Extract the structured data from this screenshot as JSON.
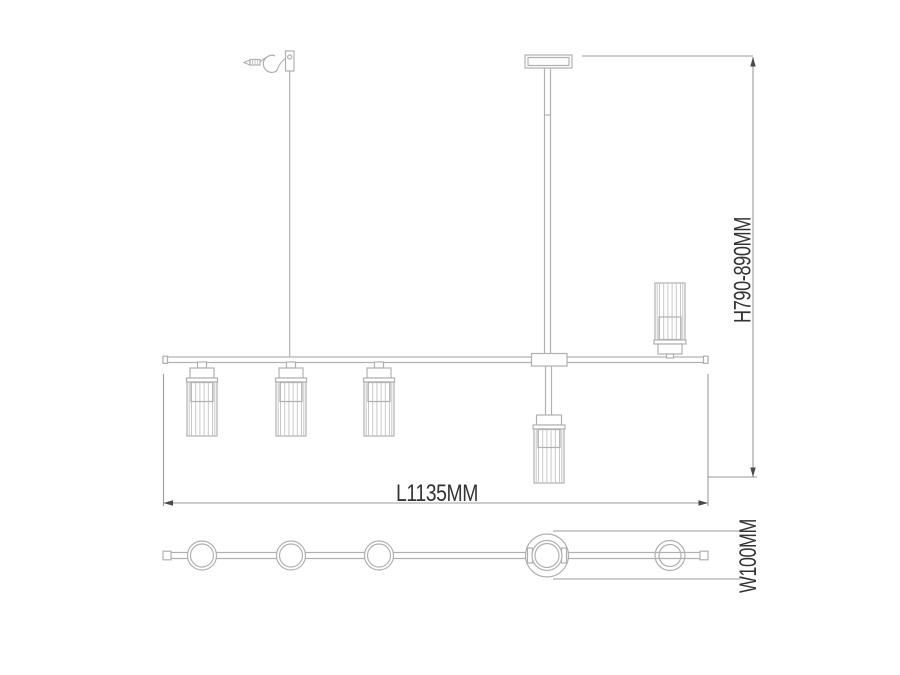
{
  "drawing": {
    "type": "technical-dimension-drawing",
    "subject": "linear-pendant-chandelier",
    "lamp_count": 5,
    "labels": {
      "height": "H790-890MM",
      "length": "L1135MM",
      "width": "W100MM"
    },
    "dimensions": {
      "height_mm": "790-890",
      "length_mm": "1135",
      "width_mm": "100"
    },
    "colors": {
      "outline": "#b0b0b0",
      "dimension_line": "#9b9b9b",
      "arrow": "#4a4a4a",
      "label_text": "#333333",
      "background": "#ffffff"
    }
  }
}
